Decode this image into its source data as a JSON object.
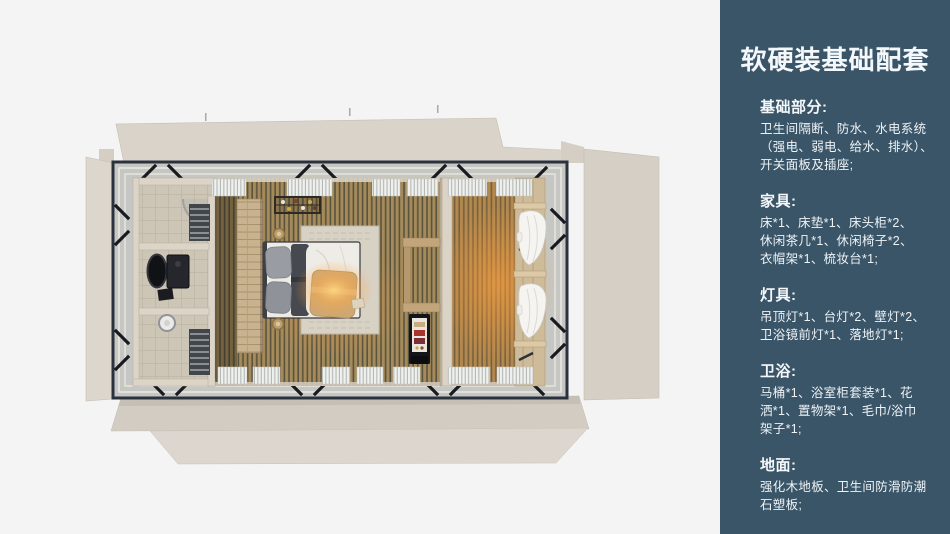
{
  "sidebar": {
    "title": "软硬装基础配套",
    "sections": [
      {
        "heading": "基础部分:",
        "lines": [
          "卫生间隔断、防水、水电系统",
          "（强电、弱电、给水、排水）、",
          "开关面板及插座;"
        ]
      },
      {
        "heading": "家具:",
        "lines": [
          "床*1、床垫*1、床头柜*2、",
          "休闲茶几*1、休闲椅子*2、",
          "衣帽架*1、梳妆台*1;"
        ]
      },
      {
        "heading": "灯具:",
        "lines": [
          "吊顶灯*1、台灯*2、壁灯*2、",
          "卫浴镜前灯*1、落地灯*1;"
        ]
      },
      {
        "heading": "卫浴:",
        "lines": [
          "马桶*1、浴室柜套装*1、花",
          "洒*1、置物架*1、毛巾/浴巾",
          "架子*1;"
        ]
      },
      {
        "heading": "地面:",
        "lines": [
          "强化木地板、卫生间防滑防潮",
          "石塑板;"
        ]
      }
    ]
  },
  "palette": {
    "background": "#f4f4f4",
    "sidebar_bg": "#3a5568",
    "sidebar_text": "#f5f8fa",
    "shell_beige": "#d8d1c8",
    "steel_frame": "#2a323e",
    "deck_gray": "#c6c7c2",
    "floor_wood": "#a58b5a",
    "floor_wood_dark": "#5a5340",
    "warm_glow": "#ffa24a",
    "wardrobe_wood": "#c8b28f",
    "bathroom_tile": "#cdc5b5",
    "bed_duvet": "#eeece7",
    "bed_throw": "#c9a877",
    "pillow_gray": "#999da3",
    "curtain_white": "#f5f4f1"
  }
}
